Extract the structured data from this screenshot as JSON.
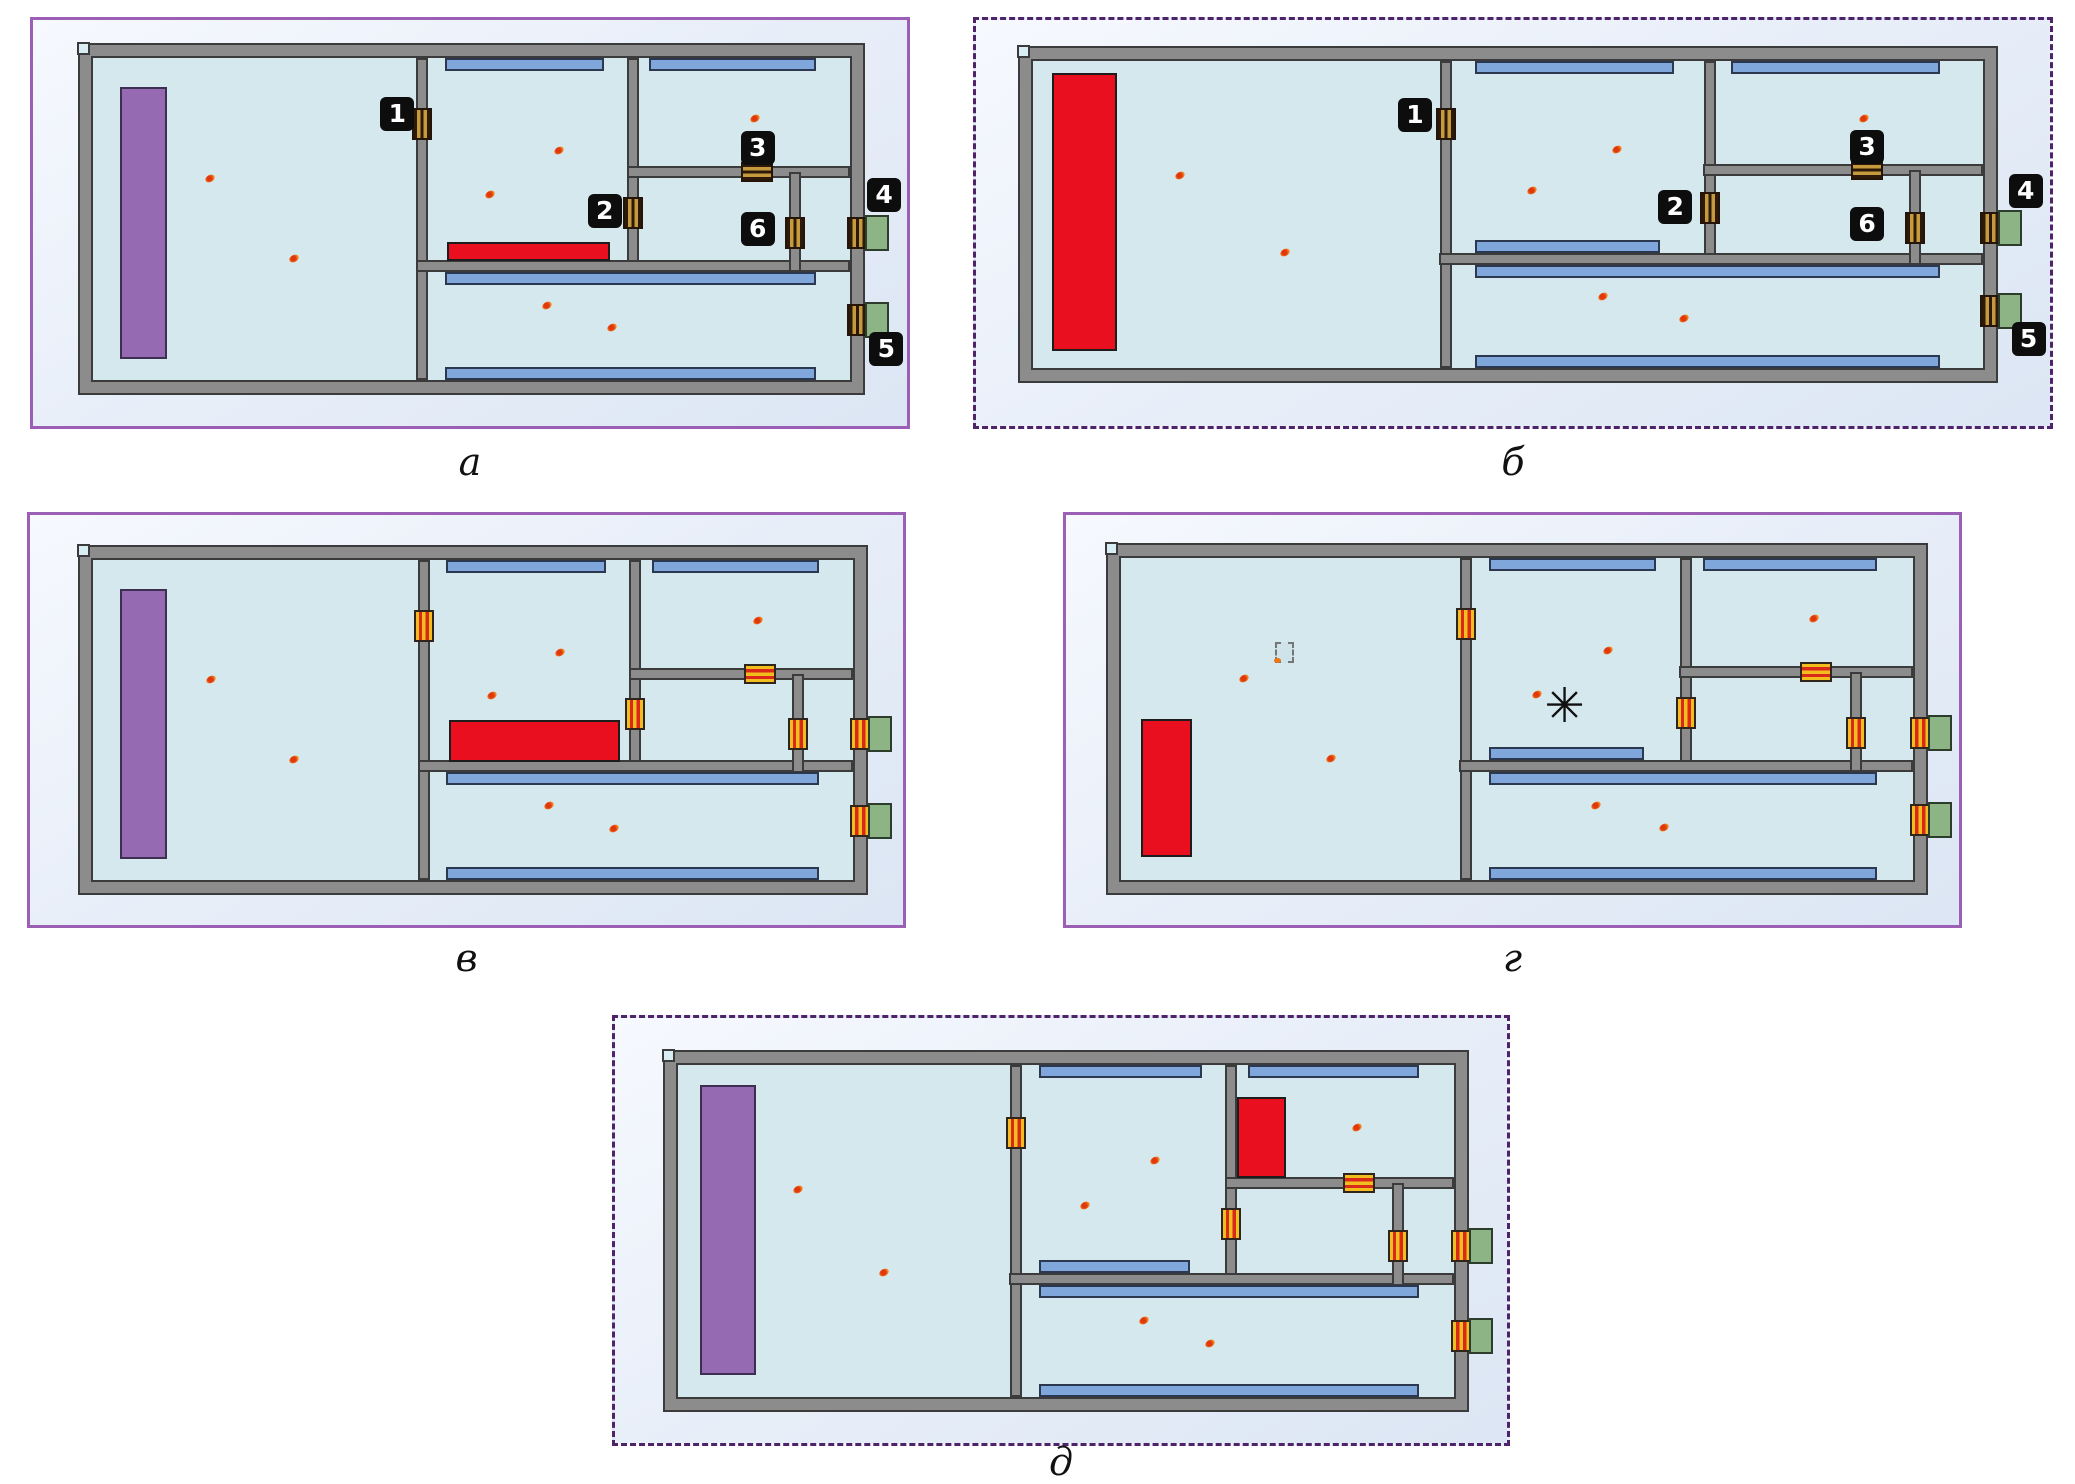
{
  "diagram": {
    "asterisk_char": "✳",
    "colors": {
      "page_background": "#ffffff",
      "panel_background": "#e9eff9",
      "panel_border_solid": "#9c5fb6",
      "panel_border_dashed": "#4f2369",
      "wall": "#8c8c8c",
      "wall_edge": "#3b3b3b",
      "room_fill": "#d4e8ee",
      "window": "#7fa7db",
      "stage_purple": "#9669b3",
      "fire_red": "#e90f1e",
      "exit_green": "#8cb485",
      "door_gold": "#c49a3c",
      "door_gold_dark": "#2c190a",
      "door_yellow": "#f2be1e",
      "door_red": "#d8291a",
      "badge_background": "#0d0d0d",
      "badge_text": "#ffffff",
      "occupant_dot": "#e86a12"
    },
    "template": {
      "walls": [
        {
          "o": "v",
          "c": 0.435,
          "from": 0.0,
          "to": 1.0
        },
        {
          "o": "v",
          "c": 0.713,
          "from": 0.0,
          "to": 0.665
        },
        {
          "o": "h",
          "c": 0.645,
          "from": 0.427,
          "to": 1.0
        },
        {
          "o": "h",
          "c": 0.355,
          "from": 0.705,
          "to": 1.0
        },
        {
          "o": "v",
          "c": 0.928,
          "from": 0.355,
          "to": 0.665
        }
      ],
      "windows": [
        {
          "edge": "top",
          "x0": 0.465,
          "x1": 0.675,
          "always": true
        },
        {
          "edge": "top",
          "x0": 0.735,
          "x1": 0.955,
          "always": true
        },
        {
          "edge": "aboveH1",
          "x0": 0.465,
          "x1": 0.66,
          "always": false
        },
        {
          "edge": "belowH1",
          "x0": 0.465,
          "x1": 0.955,
          "always": true
        },
        {
          "edge": "bottom",
          "x0": 0.465,
          "x1": 0.955,
          "always": true
        }
      ],
      "doors": [
        {
          "on": "v",
          "cx": 0.435,
          "cy": 0.205
        },
        {
          "on": "v",
          "cx": 0.713,
          "cy": 0.48
        },
        {
          "on": "h",
          "cx": 0.8775,
          "cy": 0.355
        },
        {
          "on": "v",
          "cx": 0.928,
          "cy": 0.545
        },
        {
          "on": "right-wall",
          "cy": 0.545
        },
        {
          "on": "right-wall",
          "cy": 0.815
        }
      ],
      "exits": [
        {
          "cy": 0.545
        },
        {
          "cy": 0.815
        }
      ],
      "dots": [
        [
          0.155,
          0.375
        ],
        [
          0.265,
          0.625
        ],
        [
          0.615,
          0.29
        ],
        [
          0.525,
          0.425
        ],
        [
          0.875,
          0.19
        ],
        [
          0.6,
          0.77
        ],
        [
          0.685,
          0.84
        ]
      ],
      "badges": [
        {
          "n": "1",
          "cx": 0.402,
          "cy": 0.175
        },
        {
          "n": "2",
          "cx": 0.676,
          "cy": 0.475
        },
        {
          "n": "3",
          "cx": 0.878,
          "cy": 0.28
        },
        {
          "n": "4",
          "cx": 1.045,
          "cy": 0.425
        },
        {
          "n": "5",
          "cx": 1.048,
          "cy": 0.905
        },
        {
          "n": "6",
          "cx": 0.878,
          "cy": 0.53
        }
      ]
    },
    "panels": [
      {
        "caption": "а",
        "border": "solid",
        "door_style": "gold",
        "show_badges": true,
        "show_mid_window": false,
        "box": {
          "left": 30,
          "top": 17,
          "width": 880,
          "height": 412
        },
        "building": {
          "left": 45,
          "top": 23,
          "width": 787,
          "height": 352
        },
        "caption_top": 440,
        "stage": {
          "x": 0.036,
          "y": 0.09,
          "w": 0.062,
          "h": 0.845
        },
        "fire": {
          "x": 0.468,
          "y": 0.572,
          "w": 0.215,
          "h": 0.058
        }
      },
      {
        "caption": "б",
        "border": "dashed",
        "door_style": "gold",
        "show_badges": true,
        "show_mid_window": true,
        "box": {
          "left": 973,
          "top": 17,
          "width": 1080,
          "height": 412
        },
        "building": {
          "left": 42,
          "top": 26,
          "width": 980,
          "height": 337
        },
        "caption_top": 440,
        "stage": null,
        "fire": {
          "x": 0.02,
          "y": 0.04,
          "w": 0.068,
          "h": 0.905
        }
      },
      {
        "caption": "в",
        "border": "solid",
        "door_style": "yr",
        "show_badges": false,
        "show_mid_window": false,
        "box": {
          "left": 27,
          "top": 512,
          "width": 879,
          "height": 416
        },
        "building": {
          "left": 48,
          "top": 30,
          "width": 790,
          "height": 350
        },
        "caption_top": 936,
        "stage": {
          "x": 0.036,
          "y": 0.09,
          "w": 0.062,
          "h": 0.845
        },
        "fire": {
          "x": 0.468,
          "y": 0.5,
          "w": 0.225,
          "h": 0.13
        }
      },
      {
        "caption": "г",
        "border": "solid",
        "door_style": "yr",
        "show_badges": false,
        "show_mid_window": true,
        "box": {
          "left": 1063,
          "top": 512,
          "width": 899,
          "height": 416
        },
        "building": {
          "left": 40,
          "top": 28,
          "width": 822,
          "height": 352
        },
        "caption_top": 936,
        "stage": null,
        "fire": {
          "x": 0.025,
          "y": 0.5,
          "w": 0.065,
          "h": 0.43
        },
        "ignition_icon": {
          "cx": 0.205,
          "cy": 0.29
        },
        "asterisk": {
          "cx": 0.565,
          "cy": 0.465
        }
      },
      {
        "caption": "д",
        "border": "dashed",
        "door_style": "yr",
        "show_badges": false,
        "show_mid_window": true,
        "box": {
          "left": 612,
          "top": 1015,
          "width": 898,
          "height": 431
        },
        "building": {
          "left": 48,
          "top": 32,
          "width": 806,
          "height": 362
        },
        "caption_top": 1440,
        "stage": {
          "x": 0.028,
          "y": 0.06,
          "w": 0.072,
          "h": 0.875
        },
        "fire": {
          "x": 0.72,
          "y": 0.095,
          "w": 0.063,
          "h": 0.245
        }
      }
    ]
  }
}
